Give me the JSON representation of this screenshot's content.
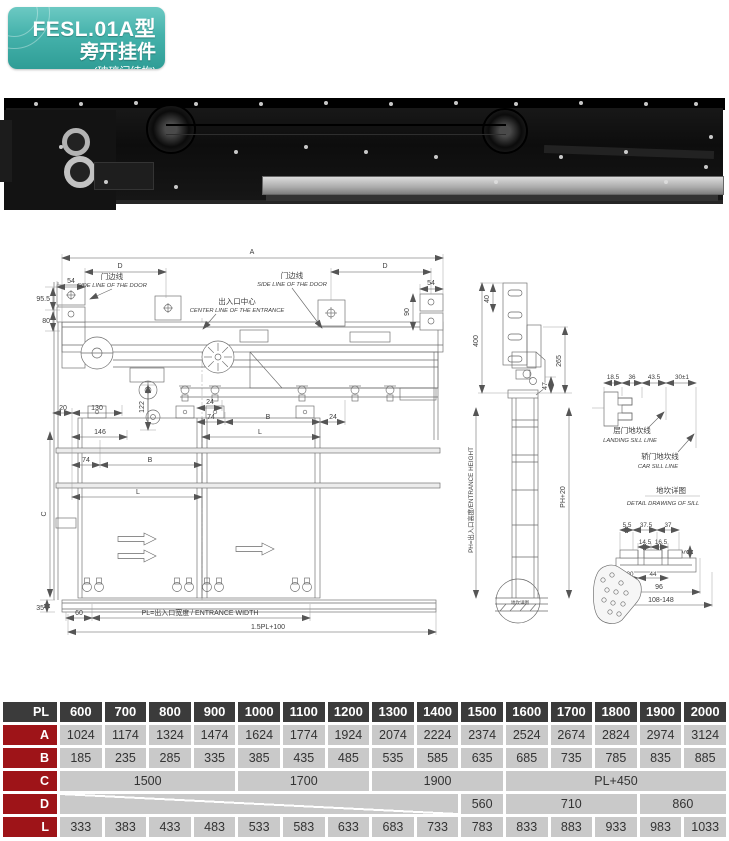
{
  "header": {
    "model": "FESL.01A型",
    "name": "旁开挂件",
    "sub": "(玻璃门结构)"
  },
  "dwg": {
    "a": "A",
    "d": "D",
    "n54": "54",
    "n95_5": "95.5",
    "n80": "80",
    "n90": "90",
    "n20": "20",
    "n130": "130",
    "n122": "122",
    "n146": "146",
    "n74": "74",
    "n24": "24",
    "b": "B",
    "l": "L",
    "c": "C",
    "n35": "35",
    "n60": "60",
    "side_line_cn": "门边线",
    "side_line_en": "SIDE LINE OF THE DOOR",
    "center_cn": "出入口中心",
    "center_en": "CENTER LINE OF THE ENTRANCE",
    "pl": "PL=出入口宽度 / ENTRANCE WIDTH",
    "pl15": "1.5PL+100",
    "n400": "400",
    "n40": "40",
    "n265": "265",
    "n47": "47",
    "ph": "PH=出入口高度/ENTRANCE HEIGHT",
    "ph20": "PH+20",
    "sill_ref": "地坎详图",
    "n18_5": "18.5",
    "n36": "36",
    "n43_5": "43.5",
    "n30": "30±1",
    "landing_cn": "层门地坎线",
    "landing_en": "LANDING SILL LINE",
    "car_cn": "轿门地坎线",
    "car_en": "CAR SILL LINE",
    "sill_title_cn": "地坎详图",
    "sill_title_en": "DETAIL DRAWING OF SILL",
    "n5_5": "5.5",
    "n37_5": "37.5",
    "n37": "37",
    "n14_5": "14.5",
    "n16_5": "16.5",
    "n5": "5",
    "n44": "44",
    "n96": "96",
    "n108": "108-148"
  },
  "table": {
    "header_label": "PL",
    "columns": [
      "600",
      "700",
      "800",
      "900",
      "1000",
      "1100",
      "1200",
      "1300",
      "1400",
      "1500",
      "1600",
      "1700",
      "1800",
      "1900",
      "2000"
    ],
    "rows": [
      {
        "label": "A",
        "cells": [
          {
            "t": "1024"
          },
          {
            "t": "1174"
          },
          {
            "t": "1324"
          },
          {
            "t": "1474"
          },
          {
            "t": "1624"
          },
          {
            "t": "1774"
          },
          {
            "t": "1924"
          },
          {
            "t": "2074"
          },
          {
            "t": "2224"
          },
          {
            "t": "2374"
          },
          {
            "t": "2524"
          },
          {
            "t": "2674"
          },
          {
            "t": "2824"
          },
          {
            "t": "2974"
          },
          {
            "t": "3124"
          }
        ]
      },
      {
        "label": "B",
        "cells": [
          {
            "t": "185"
          },
          {
            "t": "235"
          },
          {
            "t": "285"
          },
          {
            "t": "335"
          },
          {
            "t": "385"
          },
          {
            "t": "435"
          },
          {
            "t": "485"
          },
          {
            "t": "535"
          },
          {
            "t": "585"
          },
          {
            "t": "635"
          },
          {
            "t": "685"
          },
          {
            "t": "735"
          },
          {
            "t": "785"
          },
          {
            "t": "835"
          },
          {
            "t": "885"
          }
        ]
      },
      {
        "label": "C",
        "cells": [
          {
            "t": "1500",
            "s": 4
          },
          {
            "t": "1700",
            "s": 3
          },
          {
            "t": "1900",
            "s": 3
          },
          {
            "t": "PL+450",
            "s": 5
          }
        ]
      },
      {
        "label": "D",
        "cells": [
          {
            "t": "",
            "s": 9,
            "diag": true
          },
          {
            "t": "560"
          },
          {
            "t": "710",
            "s": 3
          },
          {
            "t": "860",
            "s": 2
          }
        ]
      },
      {
        "label": "L",
        "cells": [
          {
            "t": "333"
          },
          {
            "t": "383"
          },
          {
            "t": "433"
          },
          {
            "t": "483"
          },
          {
            "t": "533"
          },
          {
            "t": "583"
          },
          {
            "t": "633"
          },
          {
            "t": "683"
          },
          {
            "t": "733"
          },
          {
            "t": "783"
          },
          {
            "t": "833"
          },
          {
            "t": "883"
          },
          {
            "t": "933"
          },
          {
            "t": "983"
          },
          {
            "t": "1033"
          }
        ]
      }
    ]
  },
  "colors": {
    "badge_teal": "#3fb1aa",
    "table_header": "#3b3b3b",
    "row_label_red": "#9e1418",
    "cell_gray": "#c9c9c9"
  }
}
